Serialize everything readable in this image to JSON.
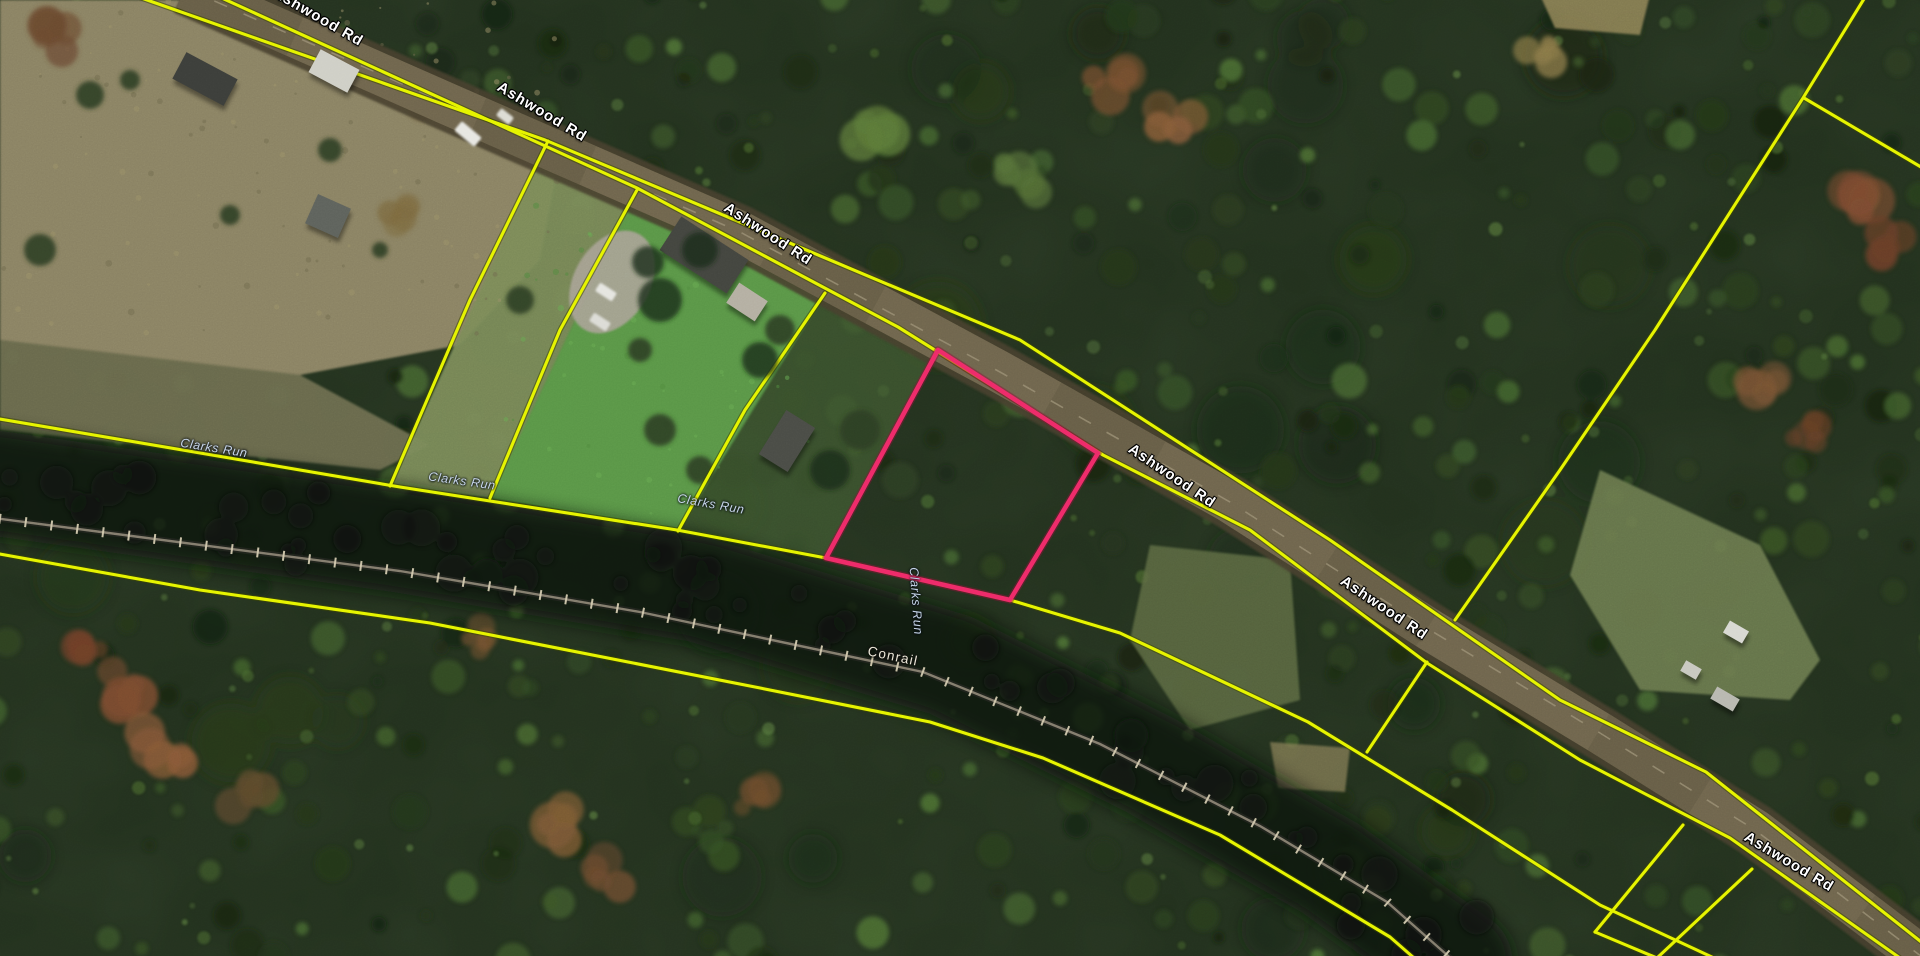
{
  "map": {
    "description": "Aerial parcel-viewer basemap with county parcel boundaries and a highlighted parcel",
    "road_name": "Ashwood Rd",
    "stream_name": "Clarks Run",
    "railroad_name": "Conrail",
    "labels": {
      "road": [
        {
          "text": "Ashwood Rd",
          "x": 318,
          "y": 17,
          "rot": 30
        },
        {
          "text": "Ashwood Rd",
          "x": 542,
          "y": 112,
          "rot": 31
        },
        {
          "text": "Ashwood Rd",
          "x": 768,
          "y": 234,
          "rot": 33
        },
        {
          "text": "Ashwood Rd",
          "x": 1172,
          "y": 476,
          "rot": 34
        },
        {
          "text": "Ashwood Rd",
          "x": 1384,
          "y": 608,
          "rot": 34
        },
        {
          "text": "Ashwood Rd",
          "x": 1789,
          "y": 862,
          "rot": 31
        }
      ],
      "stream": [
        {
          "text": "Clarks Run",
          "x": 214,
          "y": 448,
          "rot": 9
        },
        {
          "text": "Clarks Run",
          "x": 462,
          "y": 481,
          "rot": 8
        },
        {
          "text": "Clarks Run",
          "x": 711,
          "y": 504,
          "rot": 10
        },
        {
          "text": "Clarks Run",
          "x": 916,
          "y": 601,
          "rot": 86
        }
      ],
      "railroad": [
        {
          "text": "Conrail",
          "x": 893,
          "y": 656,
          "rot": 12
        }
      ]
    },
    "colors": {
      "parcel_line": "#e6f400",
      "parcel_line_halo": "#3d4600",
      "selected_parcel": "#ee2a68",
      "selected_parcel_halo": "#8a1238",
      "road_fill": "#6f654d",
      "road_shoulder": "#47402f",
      "road_centerline": "#9a8f74",
      "rail_line": "#837c6d",
      "rail_tick": "#d2c9ae",
      "forest_base": "#22301d",
      "corridor_dark": "#0b120d",
      "field": "#8a8263",
      "lawn": "#5a9647"
    },
    "selected_parcel": {
      "outline_path": "M938,350 L1098,453 L1010,600 L826,558 Z"
    },
    "parcel_lines": {
      "paths": [
        "M130,-6 L545,140 L1020,340 L1330,540 L1560,700 L1706,772 L1934,952",
        "M213,-6 L637,188 L898,327 L1103,455 L1250,530 L1427,663 L1580,760 L1730,838 L1934,982",
        "M-6,418 L400,487 L677,530 L826,558 L1010,600 L1120,633 L1308,722 L1452,810 L1600,905 L1714,958",
        "M-6,553 L200,590 L430,623 L755,687 L930,722 L1043,758 L1220,835 L1390,937 L1414,958",
        "M548,141 L470,300 L390,486",
        "M637,190 L560,330 L490,498",
        "M825,293 L745,410 L678,531",
        "M1427,662 L1367,752",
        "M1867,-6 L1803,98 L1655,330 L1560,470 L1455,620",
        "M1804,98 L1926,170",
        "M1683,825 L1595,932",
        "M1595,932 L1657,958",
        "M1752,869 L1657,958"
      ]
    },
    "road": {
      "center_path": "M185,-12 L450,105 L740,232 L1000,372 L1230,502 L1430,630 L1600,733 L1755,830 L1934,966"
    },
    "railroad": {
      "track_path": "M-6,518 L400,571 L640,612 L923,672 L1100,744 L1260,826 L1387,902 L1455,962",
      "corridor_path": "M-6,483 L400,540 L700,590 L950,665 L1150,765 L1330,868 L1460,962"
    },
    "terrain": [
      {
        "name": "pasture-top-left",
        "path": "M0,0 L213,0 L560,155 L540,260 L460,345 L300,375 L0,340 Z",
        "fill": "#8a8263",
        "op": 1
      },
      {
        "name": "pasture-strip",
        "path": "M0,340 L300,375 L430,445 L380,470 L0,430 Z",
        "fill": "#6e6e4f",
        "op": 0.95
      },
      {
        "name": "wedge-parcel",
        "path": "M548,141 L637,190 L490,498 L390,486 Z",
        "fill": "#7a8a58",
        "op": 0.95
      },
      {
        "name": "lawn-parcel",
        "path": "M637,190 L825,293 L678,531 L490,498 Z",
        "fill": "#5a9647",
        "op": 1
      },
      {
        "name": "shed-parcel",
        "path": "M825,293 L938,350 L826,558 L678,531 Z",
        "fill": "#425931",
        "op": 0.75
      },
      {
        "name": "clearing-right",
        "path": "M1600,470 L1760,545 L1820,660 L1790,700 L1640,690 L1570,575 Z",
        "fill": "#6d7b50",
        "op": 0.9
      },
      {
        "name": "olive-patch",
        "path": "M1150,545 L1290,560 L1300,700 L1190,730 L1130,640 Z",
        "fill": "#5d6b42",
        "op": 0.85
      },
      {
        "name": "tan-top",
        "path": "M1540,-5 L1650,-5 L1640,35 L1555,28 Z",
        "fill": "#9a8c5c",
        "op": 0.8
      },
      {
        "name": "tan-mid",
        "path": "M1270,742 L1350,748 L1345,792 L1278,788 Z",
        "fill": "#8c8258",
        "op": 0.7
      }
    ],
    "autumn_clusters": [
      [
        120,
        690,
        26,
        "#7c4b30"
      ],
      [
        168,
        742,
        30,
        "#8a5a38"
      ],
      [
        85,
        645,
        20,
        "#6e4028"
      ],
      [
        250,
        800,
        22,
        "#5d4a2c"
      ],
      [
        545,
        830,
        26,
        "#7d5a35"
      ],
      [
        610,
        872,
        22,
        "#6b4a2e"
      ],
      [
        480,
        640,
        18,
        "#74522f"
      ],
      [
        755,
        795,
        20,
        "#6d4c2c"
      ],
      [
        1110,
        85,
        24,
        "#7a5030"
      ],
      [
        1175,
        120,
        20,
        "#875c38"
      ],
      [
        1855,
        205,
        26,
        "#7c4a30"
      ],
      [
        1885,
        245,
        20,
        "#6b3f28"
      ],
      [
        1765,
        390,
        24,
        "#7a5434"
      ],
      [
        1808,
        432,
        18,
        "#684026"
      ],
      [
        1540,
        55,
        18,
        "#8a7a48"
      ],
      [
        395,
        218,
        16,
        "#7c6a40"
      ],
      [
        60,
        35,
        22,
        "#6b4a30"
      ],
      [
        420,
        100,
        14,
        "#77603c"
      ],
      [
        880,
        120,
        26,
        "#5c7a38"
      ],
      [
        1020,
        180,
        22,
        "#557038"
      ]
    ],
    "field_trees": [
      [
        90,
        95,
        14
      ],
      [
        130,
        80,
        10
      ],
      [
        330,
        150,
        12
      ],
      [
        470,
        80,
        10
      ],
      [
        40,
        250,
        16
      ],
      [
        230,
        215,
        10
      ],
      [
        380,
        250,
        8
      ],
      [
        520,
        300,
        14
      ],
      [
        660,
        430,
        16
      ],
      [
        700,
        470,
        14
      ],
      [
        640,
        350,
        12
      ],
      [
        780,
        330,
        15
      ],
      [
        860,
        430,
        20
      ],
      [
        900,
        480,
        18
      ]
    ],
    "canopy_over": [
      [
        660,
        300,
        22
      ],
      [
        700,
        250,
        18
      ],
      [
        648,
        262,
        16
      ],
      [
        760,
        360,
        18
      ],
      [
        830,
        470,
        20
      ]
    ],
    "buildings": [
      {
        "x": 176,
        "y": 64,
        "w": 58,
        "h": 30,
        "rot": 28,
        "fill": "#3c3e3a"
      },
      {
        "x": 312,
        "y": 58,
        "w": 44,
        "h": 26,
        "rot": 28,
        "fill": "#cfcfc6"
      },
      {
        "x": 310,
        "y": 200,
        "w": 36,
        "h": 32,
        "rot": 24,
        "fill": "#5e625c"
      },
      {
        "x": 664,
        "y": 235,
        "w": 80,
        "h": 40,
        "rot": 33,
        "fill": "#43453f"
      },
      {
        "x": 730,
        "y": 290,
        "w": 34,
        "h": 24,
        "rot": 33,
        "fill": "#b4afa2"
      },
      {
        "x": 770,
        "y": 415,
        "w": 34,
        "h": 52,
        "rot": 32,
        "fill": "#4a4c46"
      },
      {
        "x": 1725,
        "y": 625,
        "w": 22,
        "h": 14,
        "rot": 30,
        "fill": "#d8d8d2"
      },
      {
        "x": 1682,
        "y": 664,
        "w": 18,
        "h": 12,
        "rot": 30,
        "fill": "#c8c8c0"
      },
      {
        "x": 1712,
        "y": 692,
        "w": 26,
        "h": 14,
        "rot": 30,
        "fill": "#b8b8b0"
      }
    ],
    "vehicles": [
      {
        "x": 455,
        "y": 128,
        "w": 26,
        "h": 12,
        "rot": 40,
        "fill": "#e7e7e2"
      },
      {
        "x": 596,
        "y": 287,
        "w": 20,
        "h": 10,
        "rot": 33,
        "fill": "#e5e5e0"
      },
      {
        "x": 590,
        "y": 317,
        "w": 20,
        "h": 10,
        "rot": 33,
        "fill": "#dcdcd6"
      },
      {
        "x": 497,
        "y": 112,
        "w": 16,
        "h": 9,
        "rot": 38,
        "fill": "#dcdcd4"
      }
    ],
    "driveway": {
      "cx": 612,
      "cy": 282,
      "rx": 38,
      "ry": 55,
      "rot": 30,
      "fill": "#a8a294"
    }
  }
}
